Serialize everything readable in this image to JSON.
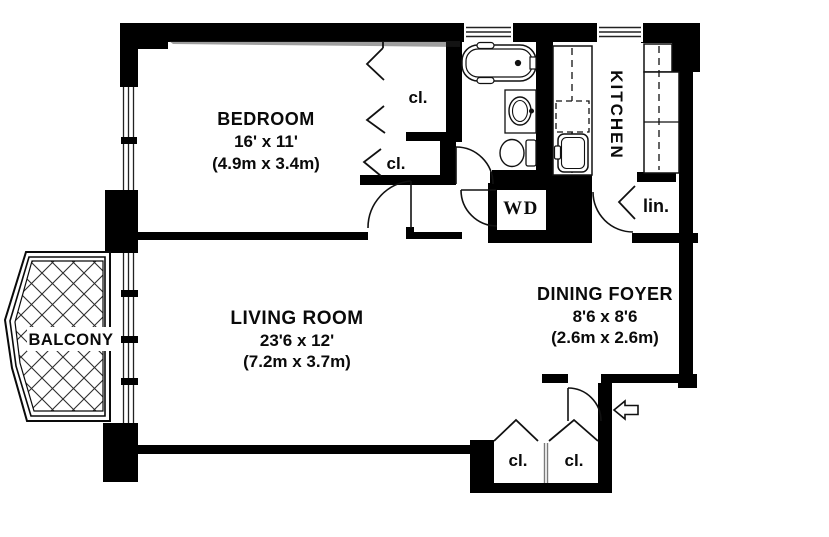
{
  "plan": {
    "title": "apartment-floor-plan",
    "bedroom": {
      "name": "BEDROOM",
      "dims": "16' x 11'",
      "dims_metric": "(4.9m x 3.4m)"
    },
    "living_room": {
      "name": "LIVING ROOM",
      "dims": "23'6 x 12'",
      "dims_metric": "(7.2m x 3.7m)"
    },
    "dining_foyer": {
      "name": "DINING FOYER",
      "dims": "8'6 x 8'6",
      "dims_metric": "(2.6m x 2.6m)"
    },
    "kitchen": {
      "name": "KITCHEN"
    },
    "balcony": {
      "name": "BALCONY"
    },
    "laundry": {
      "name": "WD"
    },
    "linen_closet": {
      "name": "lin."
    },
    "closet_bedroom_upper": {
      "name": "cl."
    },
    "closet_bedroom_lower": {
      "name": "cl."
    },
    "closet_entry_left": {
      "name": "cl."
    },
    "closet_entry_right": {
      "name": "cl."
    },
    "icons": {
      "entry_arrow": "left-arrow"
    },
    "colors": {
      "wall": "#000000",
      "background": "#ffffff",
      "line": "#1a1a1a"
    }
  }
}
